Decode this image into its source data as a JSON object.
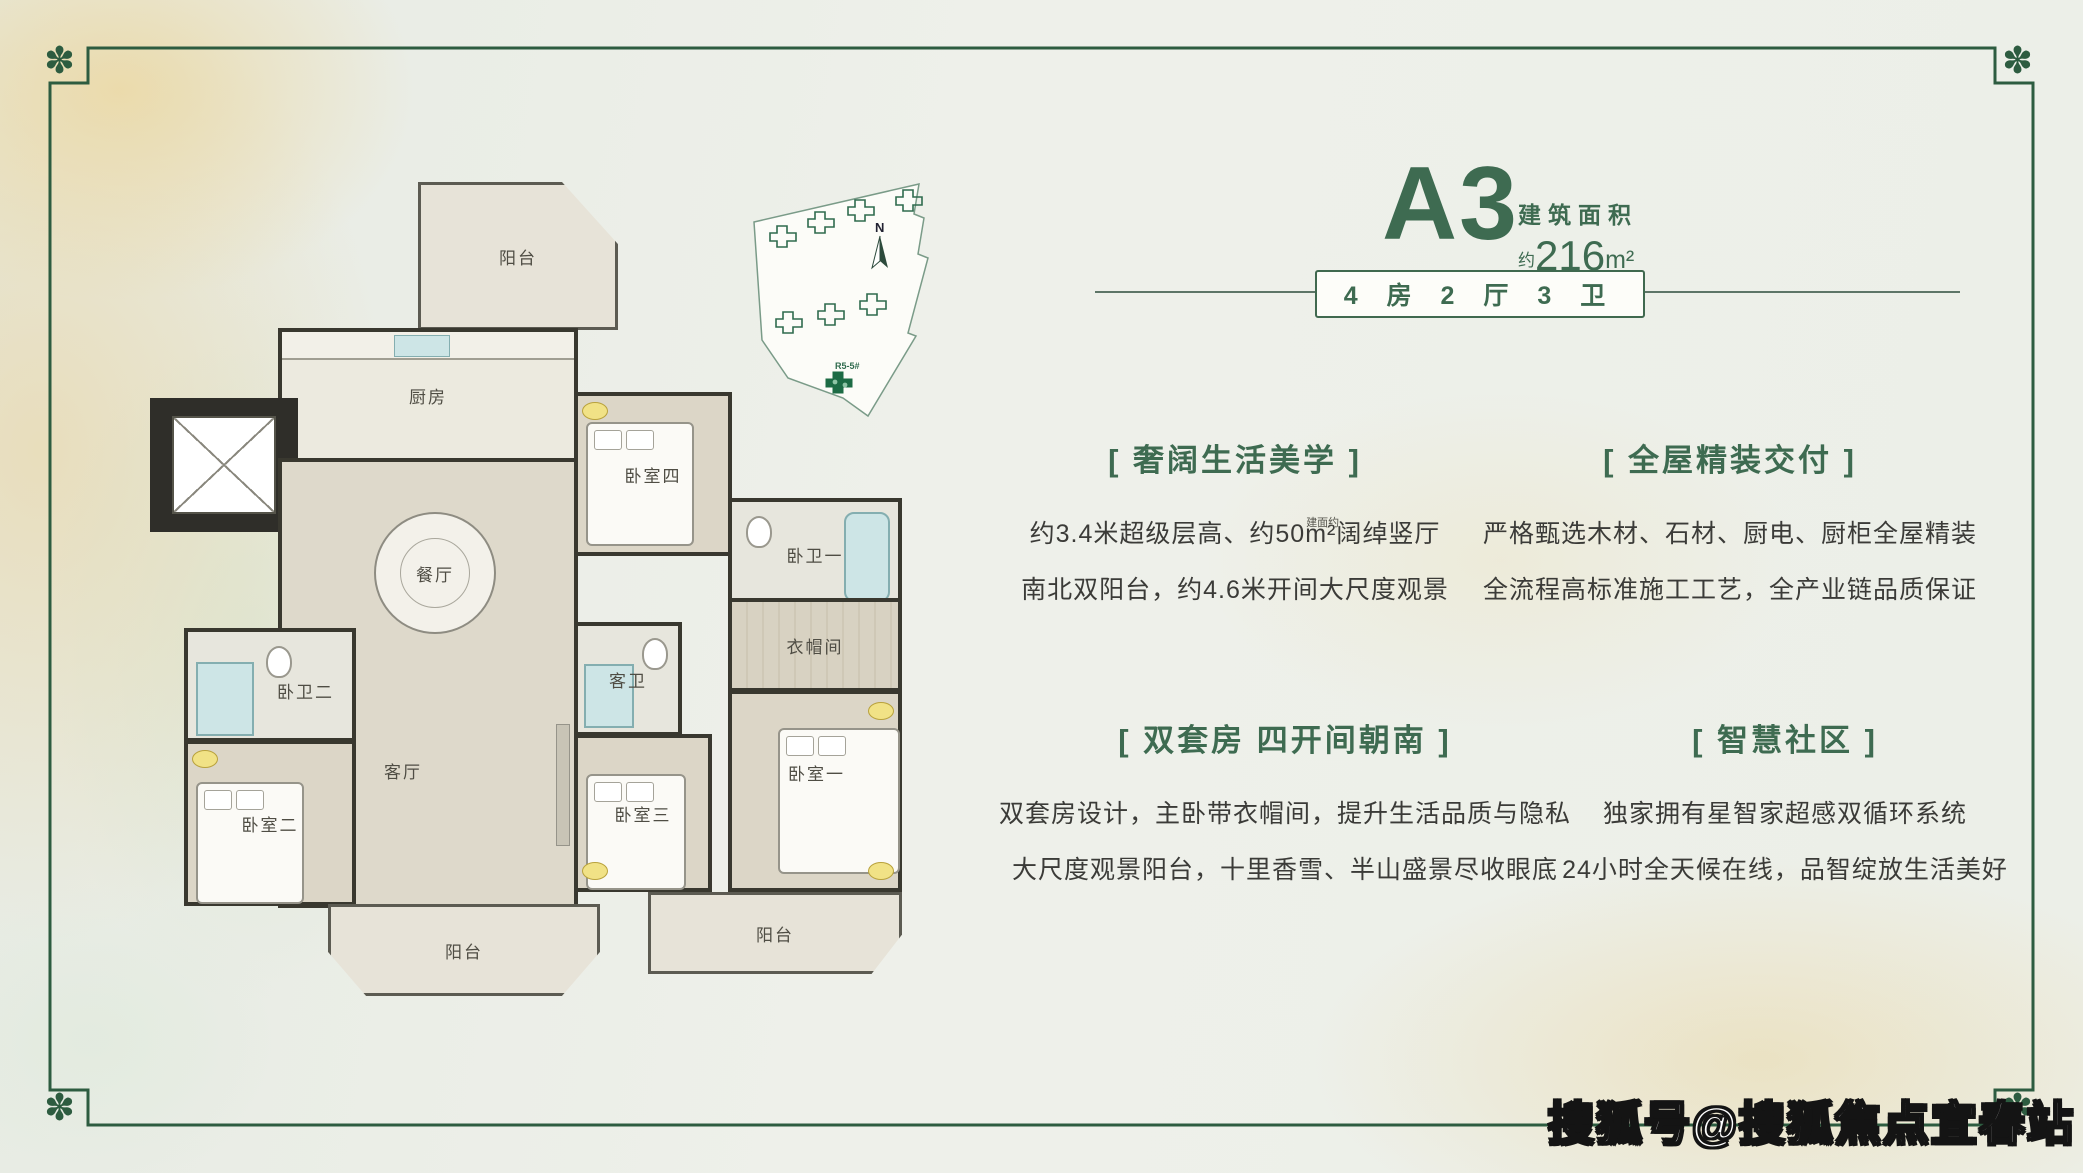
{
  "colors": {
    "accent_green": "#3e6b51",
    "frame_green": "#2d5c40",
    "body_text": "#3b3b38"
  },
  "frame": {
    "corner_ornament": "✽"
  },
  "unit": {
    "code": "A3",
    "area_label": "建筑面积",
    "area_approx": "约",
    "area_value": "216",
    "area_unit": "m²",
    "layout_spec": "4 房 2 厅 3 卫"
  },
  "features": [
    {
      "title": "[ 奢阔生活美学 ]",
      "line1_a": "约3.4米超级层高、约50",
      "line1_unit": "m²",
      "line1_note": "建面约",
      "line1_b": "阔绰竖厅",
      "line2": "南北双阳台，约4.6米开间大尺度观景"
    },
    {
      "title": "[ 全屋精装交付 ]",
      "line1": "严格甄选木材、石材、厨电、厨柜全屋精装",
      "line2": "全流程高标准施工工艺，全产业链品质保证"
    },
    {
      "title": "[ 双套房 四开间朝南 ]",
      "line1": "双套房设计，主卧带衣帽间，提升生活品质与隐私",
      "line2": "大尺度观景阳台，十里香雪、半山盛景尽收眼底"
    },
    {
      "title": "[ 智慧社区 ]",
      "line1": "独家拥有星智家超感双循环系统",
      "line2": "24小时全天候在线，品智绽放生活美好"
    }
  ],
  "floor_plan": {
    "rooms": {
      "balcony_top": "阳台",
      "kitchen": "厨房",
      "dining": "餐厅",
      "bedroom4": "卧室四",
      "suite_bath_1": "卧卫一",
      "guest_bath": "客卫",
      "closet": "衣帽间",
      "bedroom1": "卧室一",
      "bedroom3": "卧室三",
      "living": "客厅",
      "suite_bath_2": "卧卫二",
      "bedroom2": "卧室二",
      "balcony_bottom_left": "阳台",
      "balcony_bottom_right": "阳台"
    }
  },
  "site_plan": {
    "north_label": "N",
    "highlight_building_label": "R5-5#"
  },
  "watermark": "搜狐号@搜狐焦点宜春站"
}
